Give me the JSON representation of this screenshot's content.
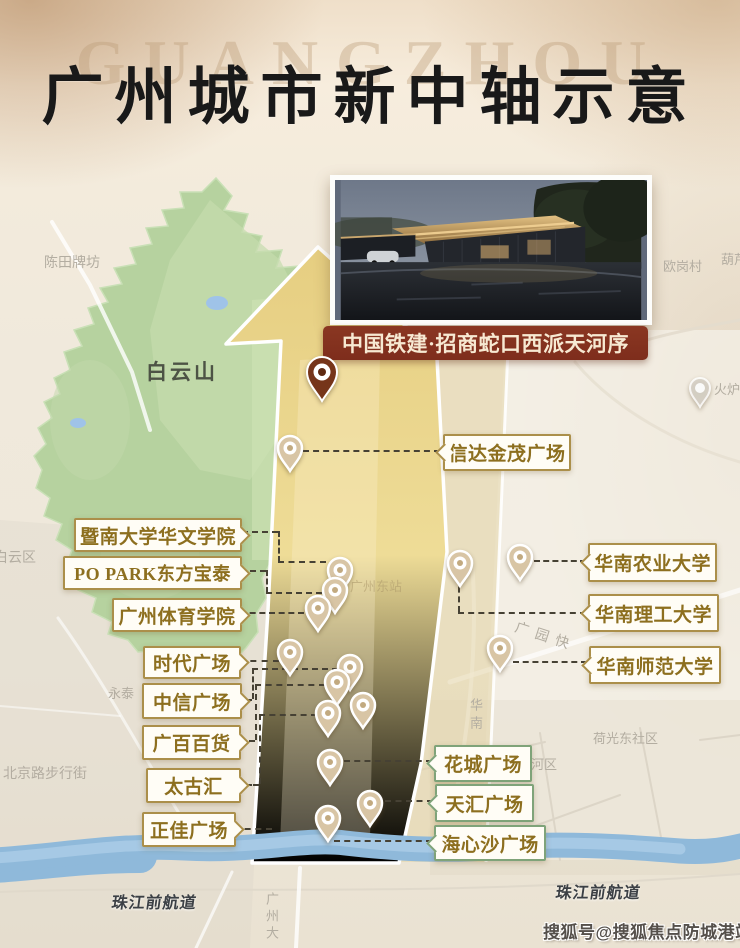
{
  "title": {
    "text": "广州城市新中轴示意",
    "watermark": "GUANGZHOU"
  },
  "photo_card": {
    "caption": "中国铁建·招商蛇口西派天河序"
  },
  "footer": {
    "watermark": "搜狐号@搜狐焦点防城港站"
  },
  "colors": {
    "banner_bg": "#7e2d1c",
    "gold_border": "#ab8f4a",
    "green_border": "#7fa379",
    "gold_text": "#8d6f1f",
    "pin_fill": "#d8c5a5",
    "pin_dot": "#c2aa80",
    "project_pin_fill": "#76351a",
    "project_pin_dot": "#5f2a12",
    "gray_pin_fill": "#d9d4cb",
    "axis_yellow": "#ecd98e",
    "mountain_green": "#b6d29f",
    "river_blue": "#8fb9da"
  },
  "map": {
    "callouts": [
      {
        "text": "暨南大学华文学院",
        "x": 74,
        "y": 518,
        "w": 164,
        "h": 30,
        "fs": 19,
        "notch": "right",
        "theme": "gold"
      },
      {
        "text": "PO PARK东方宝泰",
        "x": 63,
        "y": 556,
        "w": 175,
        "h": 30,
        "fs": 18,
        "notch": "right",
        "theme": "gold"
      },
      {
        "text": "广州体育学院",
        "x": 112,
        "y": 598,
        "w": 126,
        "h": 30,
        "fs": 19,
        "notch": "right",
        "theme": "gold"
      },
      {
        "text": "时代广场",
        "x": 143,
        "y": 646,
        "w": 94,
        "h": 29,
        "fs": 19,
        "notch": "right",
        "theme": "gold"
      },
      {
        "text": "中信广场",
        "x": 142,
        "y": 683,
        "w": 96,
        "h": 32,
        "fs": 19,
        "notch": "right",
        "theme": "gold"
      },
      {
        "text": "广百百货",
        "x": 142,
        "y": 725,
        "w": 95,
        "h": 31,
        "fs": 19,
        "notch": "right",
        "theme": "gold"
      },
      {
        "text": "太古汇",
        "x": 146,
        "y": 768,
        "w": 91,
        "h": 31,
        "fs": 19,
        "notch": "right",
        "theme": "gold"
      },
      {
        "text": "正佳广场",
        "x": 142,
        "y": 812,
        "w": 90,
        "h": 31,
        "fs": 19,
        "notch": "right",
        "theme": "gold"
      },
      {
        "text": "信达金茂广场",
        "x": 443,
        "y": 434,
        "w": 124,
        "h": 33,
        "fs": 19,
        "notch": "left",
        "theme": "gold"
      },
      {
        "text": "华南农业大学",
        "x": 588,
        "y": 543,
        "w": 125,
        "h": 35,
        "fs": 19,
        "notch": "left",
        "theme": "gold"
      },
      {
        "text": "华南理工大学",
        "x": 588,
        "y": 594,
        "w": 127,
        "h": 34,
        "fs": 19,
        "notch": "left",
        "theme": "gold"
      },
      {
        "text": "华南师范大学",
        "x": 589,
        "y": 646,
        "w": 128,
        "h": 34,
        "fs": 19,
        "notch": "left",
        "theme": "gold"
      },
      {
        "text": "花城广场",
        "x": 434,
        "y": 745,
        "w": 94,
        "h": 33,
        "fs": 19,
        "notch": "left",
        "theme": "green"
      },
      {
        "text": "天汇广场",
        "x": 435,
        "y": 784,
        "w": 95,
        "h": 34,
        "fs": 19,
        "notch": "left",
        "theme": "green"
      },
      {
        "text": "海心沙广场",
        "x": 434,
        "y": 825,
        "w": 108,
        "h": 32,
        "fs": 19,
        "notch": "left",
        "theme": "green"
      }
    ],
    "pins": [
      {
        "x": 322,
        "y": 372,
        "type": "project"
      },
      {
        "x": 290,
        "y": 448,
        "type": "tan"
      },
      {
        "x": 340,
        "y": 570,
        "type": "tan"
      },
      {
        "x": 335,
        "y": 590,
        "type": "tan"
      },
      {
        "x": 318,
        "y": 608,
        "type": "tan"
      },
      {
        "x": 290,
        "y": 652,
        "type": "tan"
      },
      {
        "x": 350,
        "y": 667,
        "type": "tan"
      },
      {
        "x": 337,
        "y": 682,
        "type": "tan"
      },
      {
        "x": 363,
        "y": 705,
        "type": "tan"
      },
      {
        "x": 328,
        "y": 713,
        "type": "tan"
      },
      {
        "x": 330,
        "y": 762,
        "type": "tan"
      },
      {
        "x": 370,
        "y": 803,
        "type": "tan"
      },
      {
        "x": 328,
        "y": 818,
        "type": "tan"
      },
      {
        "x": 460,
        "y": 563,
        "type": "tan"
      },
      {
        "x": 520,
        "y": 557,
        "type": "tan"
      },
      {
        "x": 500,
        "y": 648,
        "type": "tan"
      },
      {
        "x": 700,
        "y": 388,
        "type": "gray"
      }
    ],
    "connectors": [
      {
        "x": 303,
        "y": 450,
        "len": 137,
        "o": "h"
      },
      {
        "x": 242,
        "y": 531,
        "len": 36,
        "o": "h"
      },
      {
        "x": 278,
        "y": 531,
        "len": 31,
        "o": "v"
      },
      {
        "x": 278,
        "y": 561,
        "len": 48,
        "o": "h"
      },
      {
        "x": 240,
        "y": 570,
        "len": 26,
        "o": "h"
      },
      {
        "x": 266,
        "y": 570,
        "len": 23,
        "o": "v"
      },
      {
        "x": 266,
        "y": 592,
        "len": 56,
        "o": "h"
      },
      {
        "x": 240,
        "y": 612,
        "len": 64,
        "o": "h"
      },
      {
        "x": 239,
        "y": 660,
        "len": 40,
        "o": "h"
      },
      {
        "x": 240,
        "y": 699,
        "len": 12,
        "o": "h"
      },
      {
        "x": 252,
        "y": 668,
        "len": 31,
        "o": "v"
      },
      {
        "x": 252,
        "y": 668,
        "len": 86,
        "o": "h"
      },
      {
        "x": 239,
        "y": 740,
        "len": 16,
        "o": "h"
      },
      {
        "x": 255,
        "y": 684,
        "len": 56,
        "o": "v"
      },
      {
        "x": 255,
        "y": 684,
        "len": 70,
        "o": "h"
      },
      {
        "x": 239,
        "y": 784,
        "len": 20,
        "o": "h"
      },
      {
        "x": 259,
        "y": 714,
        "len": 70,
        "o": "v"
      },
      {
        "x": 259,
        "y": 714,
        "len": 58,
        "o": "h"
      },
      {
        "x": 234,
        "y": 828,
        "len": 38,
        "o": "h"
      },
      {
        "x": 534,
        "y": 560,
        "len": 52,
        "o": "h"
      },
      {
        "x": 458,
        "y": 577,
        "len": 35,
        "o": "v"
      },
      {
        "x": 458,
        "y": 612,
        "len": 128,
        "o": "h"
      },
      {
        "x": 513,
        "y": 661,
        "len": 74,
        "o": "h"
      },
      {
        "x": 344,
        "y": 760,
        "len": 88,
        "o": "h"
      },
      {
        "x": 385,
        "y": 800,
        "len": 48,
        "o": "h"
      },
      {
        "x": 334,
        "y": 840,
        "len": 98,
        "o": "h"
      }
    ],
    "area_labels": [
      {
        "text": "陈田牌坊",
        "x": 44,
        "y": 252,
        "fs": 14
      },
      {
        "text": "欧岗村",
        "x": 663,
        "y": 256,
        "fs": 13
      },
      {
        "text": "葫芦",
        "x": 721,
        "y": 249,
        "fs": 13
      },
      {
        "text": "白云山",
        "x": 146,
        "y": 356,
        "fs": 21,
        "bold": true,
        "color": "#4d5345",
        "ls": 3
      },
      {
        "text": "白云区",
        "x": -6,
        "y": 547,
        "fs": 14
      },
      {
        "text": "永泰",
        "x": 108,
        "y": 683,
        "fs": 13
      },
      {
        "text": "北京路步行街",
        "x": 3,
        "y": 763,
        "fs": 14
      },
      {
        "text": "广州东站",
        "x": 350,
        "y": 576,
        "fs": 13,
        "color": "rgba(172,152,106,0.55)"
      },
      {
        "text": "广园快",
        "x": 514,
        "y": 626,
        "fs": 14,
        "rot": 18,
        "ls": 7
      },
      {
        "text": "华南",
        "x": 466,
        "y": 698,
        "fs": 13,
        "vertical": true,
        "ls": 5
      },
      {
        "text": "荷光东社区",
        "x": 593,
        "y": 728,
        "fs": 13
      },
      {
        "text": "河区",
        "x": 531,
        "y": 754,
        "fs": 13
      },
      {
        "text": "火炉",
        "x": 714,
        "y": 379,
        "fs": 13
      },
      {
        "text": "广州大",
        "x": 262,
        "y": 892,
        "fs": 13,
        "vertical": true,
        "ls": 4
      },
      {
        "text": "珠江前航道",
        "x": 112,
        "y": 889,
        "fs": 16,
        "river": true
      },
      {
        "text": "珠江前航道",
        "x": 556,
        "y": 879,
        "fs": 16,
        "river": true
      }
    ]
  }
}
